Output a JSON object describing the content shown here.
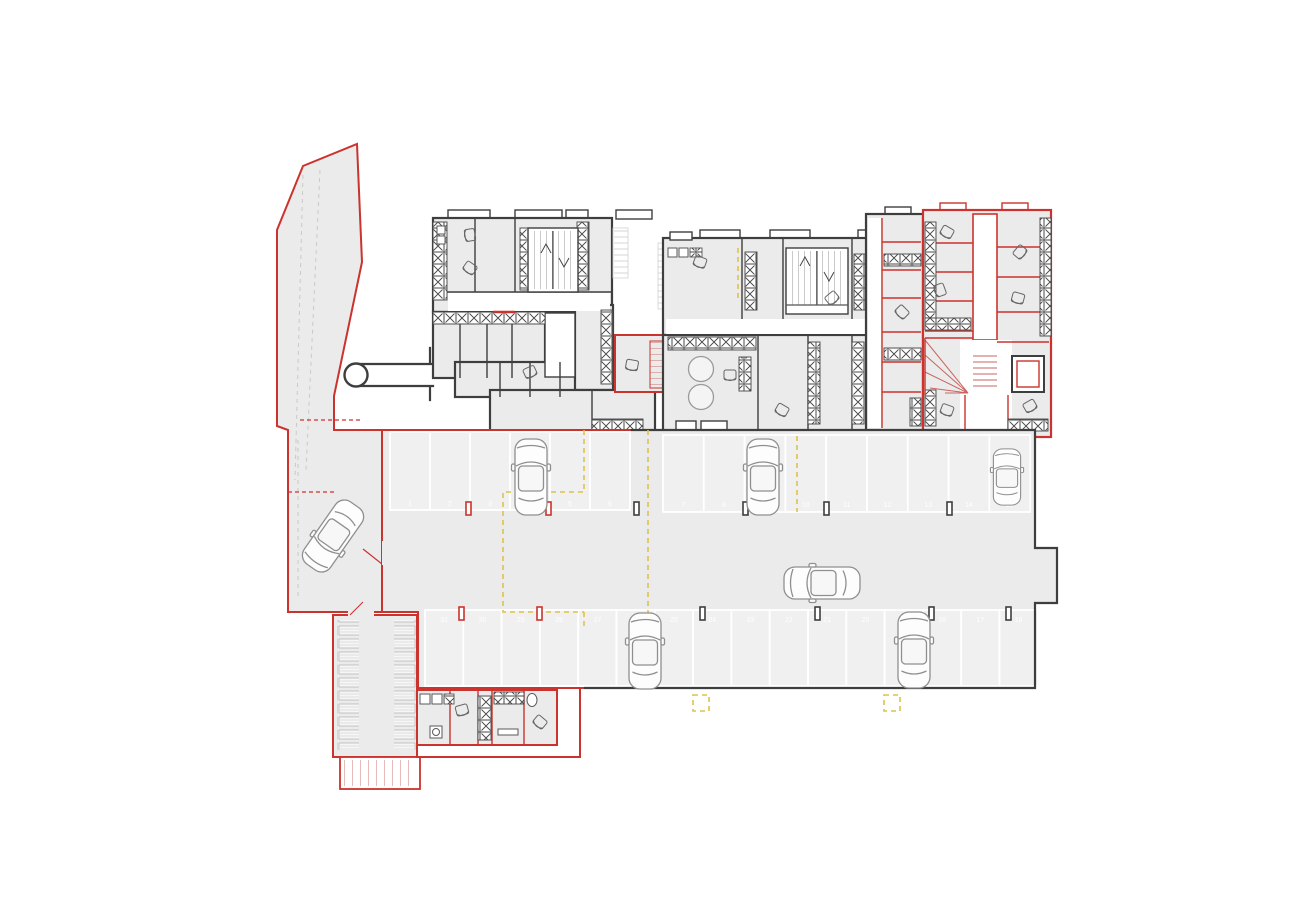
{
  "plan": {
    "colors": {
      "wall": "#3e3e3e",
      "red": "#cb332e",
      "floor": "#ebebeb",
      "stall_floor": "#f0f0f0",
      "yellow_dash": "#dcc34b",
      "orange_dash": "#e2a23c",
      "car_line": "#8f8f8f",
      "stall_number": "#ffffff"
    },
    "parking": {
      "top_row_numbers": [
        "1",
        "2",
        "3",
        "4",
        "5",
        "6",
        "7",
        "8",
        "9",
        "10",
        "11",
        "12",
        "13",
        "14",
        "15"
      ],
      "bottom_row_numbers": [
        "31",
        "30",
        "29",
        "28",
        "27",
        "26",
        "25",
        "24",
        "23",
        "22",
        "21",
        "20",
        "19",
        "18",
        "17",
        "16"
      ]
    },
    "counts": {
      "cars": 7,
      "parking_stalls": 31,
      "stair_runs": 5
    },
    "icons": {
      "car": "car-top-view-icon",
      "stairs": "stair-run-icon",
      "winder_stairs": "winding-stair-icon",
      "elevator": "elevator-shaft-icon",
      "wall_hatch": "masonry-x-hatch-icon",
      "storage_rack": "storage-rack-icon",
      "tank": "round-tank-icon",
      "chair": "furniture-chair-icon",
      "sink": "sink-icon",
      "tunnel_pipe": "round-duct-icon"
    }
  }
}
